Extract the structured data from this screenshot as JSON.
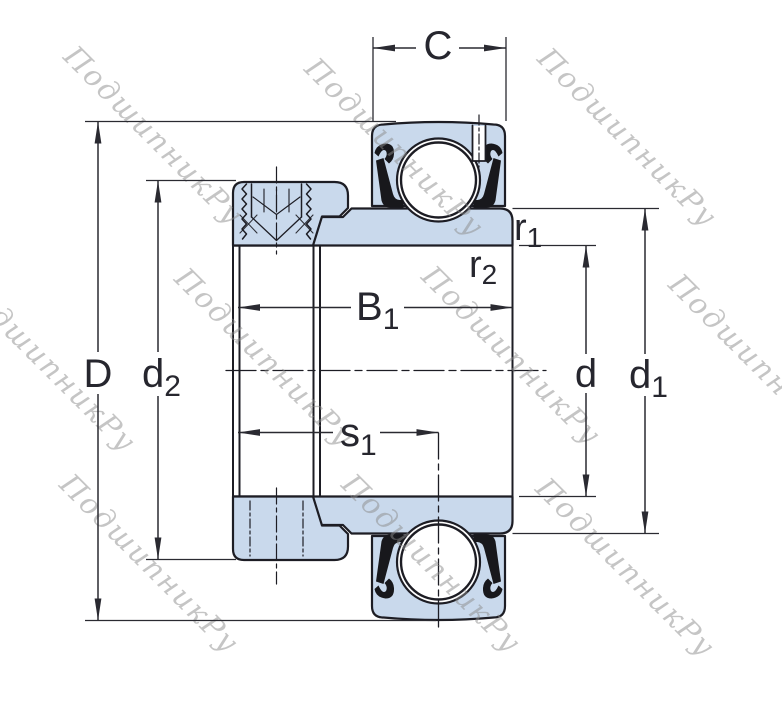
{
  "watermark": {
    "text": "ПодшипникРу"
  },
  "labels": {
    "C": {
      "base": "C",
      "sub": ""
    },
    "B1": {
      "base": "B",
      "sub": "1"
    },
    "s1": {
      "base": "s",
      "sub": "1"
    },
    "D": {
      "base": "D",
      "sub": ""
    },
    "d2": {
      "base": "d",
      "sub": "2"
    },
    "d": {
      "base": "d",
      "sub": ""
    },
    "d1": {
      "base": "d",
      "sub": "1"
    },
    "r1": {
      "base": "r",
      "sub": "1"
    },
    "r2": {
      "base": "r",
      "sub": "2"
    }
  },
  "colors": {
    "background": "#ffffff",
    "part_fill": "#c9d9ec",
    "outline": "#1d1d24",
    "seal": "#18181c",
    "dim_line": "#2a2a31",
    "label_text": "#26262e",
    "watermark": "#8a8a8a"
  }
}
